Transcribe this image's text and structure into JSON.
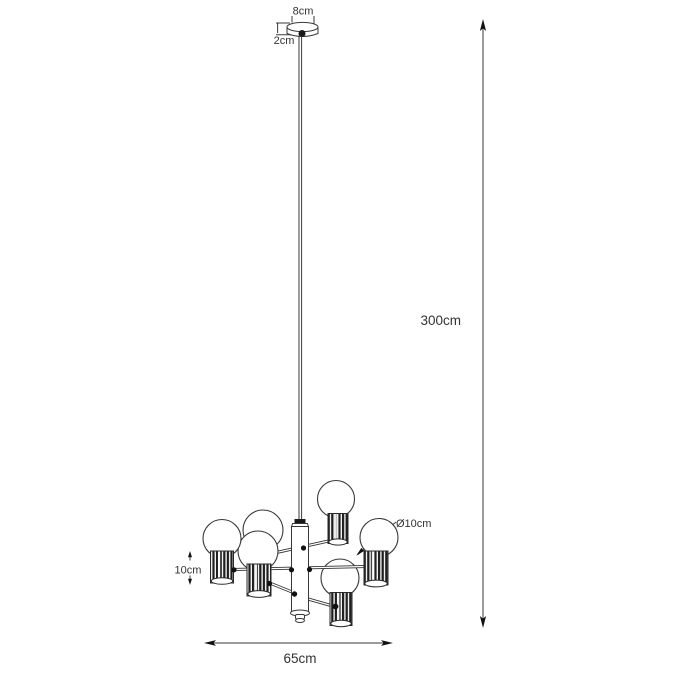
{
  "diagram": {
    "kind": "product-dimension-drawing",
    "subject": "six-light chandelier pendant with globe bulbs and ribbed cylinder sockets",
    "labels": {
      "canopy_width": "8cm",
      "canopy_height": "2cm",
      "drop_height": "300cm",
      "bulb_diameter": "Ø10cm",
      "socket_height": "10cm",
      "fixture_width": "65cm"
    },
    "counts": {
      "bulbs_visible": 6,
      "sockets_visible": 5
    },
    "colors": {
      "background": "#ffffff",
      "line": "#3a3a3a",
      "socket_dark": "#1f1f1f",
      "text": "#333333"
    }
  }
}
